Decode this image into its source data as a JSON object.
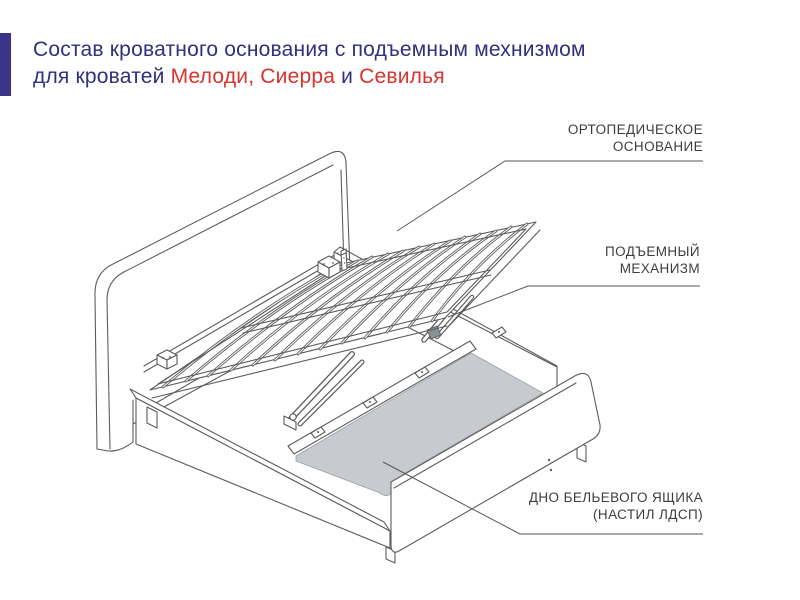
{
  "colors": {
    "accent": "#3a3387",
    "navy": "#332e7d",
    "red": "#da322d",
    "line": "#5c5c5c",
    "panel": "#c7cbd0"
  },
  "title": {
    "line1": "Состав кроватного основания с подъемным мехнизмом",
    "line2_prefix": "для кроватей ",
    "line2_model1": "Мелоди, Сиерра",
    "line2_conj": " и ",
    "line2_model2": "Севилья"
  },
  "callouts": {
    "orthopedic": {
      "line1": "ОРТОПЕДИЧЕСКОЕ",
      "line2": "ОСНОВАНИЕ"
    },
    "lift": {
      "line1": "ПОДЪЕМНЫЙ",
      "line2": "МЕХАНИЗМ"
    },
    "bottom": {
      "line1": "ДНО БЕЛЬЕВОГО ЯЩИКА",
      "line2": "(НАСТИЛ ЛДСП)"
    }
  },
  "diagram": {
    "description": "Isometric line drawing of a bed base with lifted orthopedic slatted frame, gas-lift mechanism and LDSP storage-box bottom",
    "parts": [
      "ортопедическое основание",
      "подъемный механизм",
      "дно бельевого ящика (настил ЛДСП)"
    ]
  }
}
